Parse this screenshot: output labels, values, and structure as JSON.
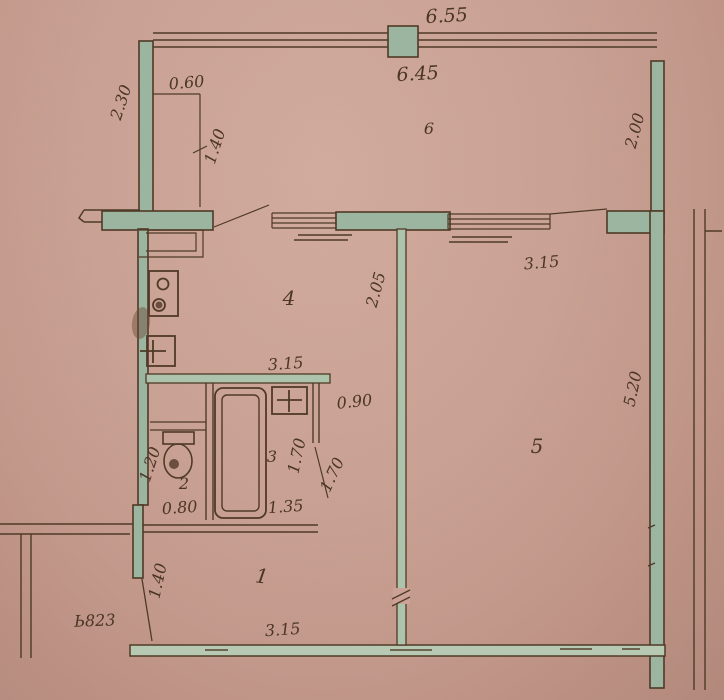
{
  "title": "apartment-floor-plan",
  "palette": {
    "paper": "#cda093",
    "wall_fill": "#9cb5a0",
    "line": "#4f3a26",
    "ink": "#4b3524"
  },
  "rooms": {
    "hall": {
      "label": "1",
      "width": "3.15",
      "depth": "1.40"
    },
    "wc": {
      "label": "2",
      "width": "0.80",
      "depth": "1.20"
    },
    "bath": {
      "label": "3",
      "width": "1.35",
      "depth": "1.70",
      "door": "1.70",
      "passage": "0.90"
    },
    "kitchen": {
      "label": "4",
      "width": "3.15",
      "depth": "2.05"
    },
    "living": {
      "label": "5",
      "window": "3.15",
      "depth": "5.20"
    },
    "balcony": {
      "label": "6",
      "outer": "6.55",
      "inner": "6.45",
      "left": "2.30",
      "right": "2.00",
      "closet_w": "0.60",
      "closet_d": "1.40"
    }
  },
  "note": "Ь823"
}
